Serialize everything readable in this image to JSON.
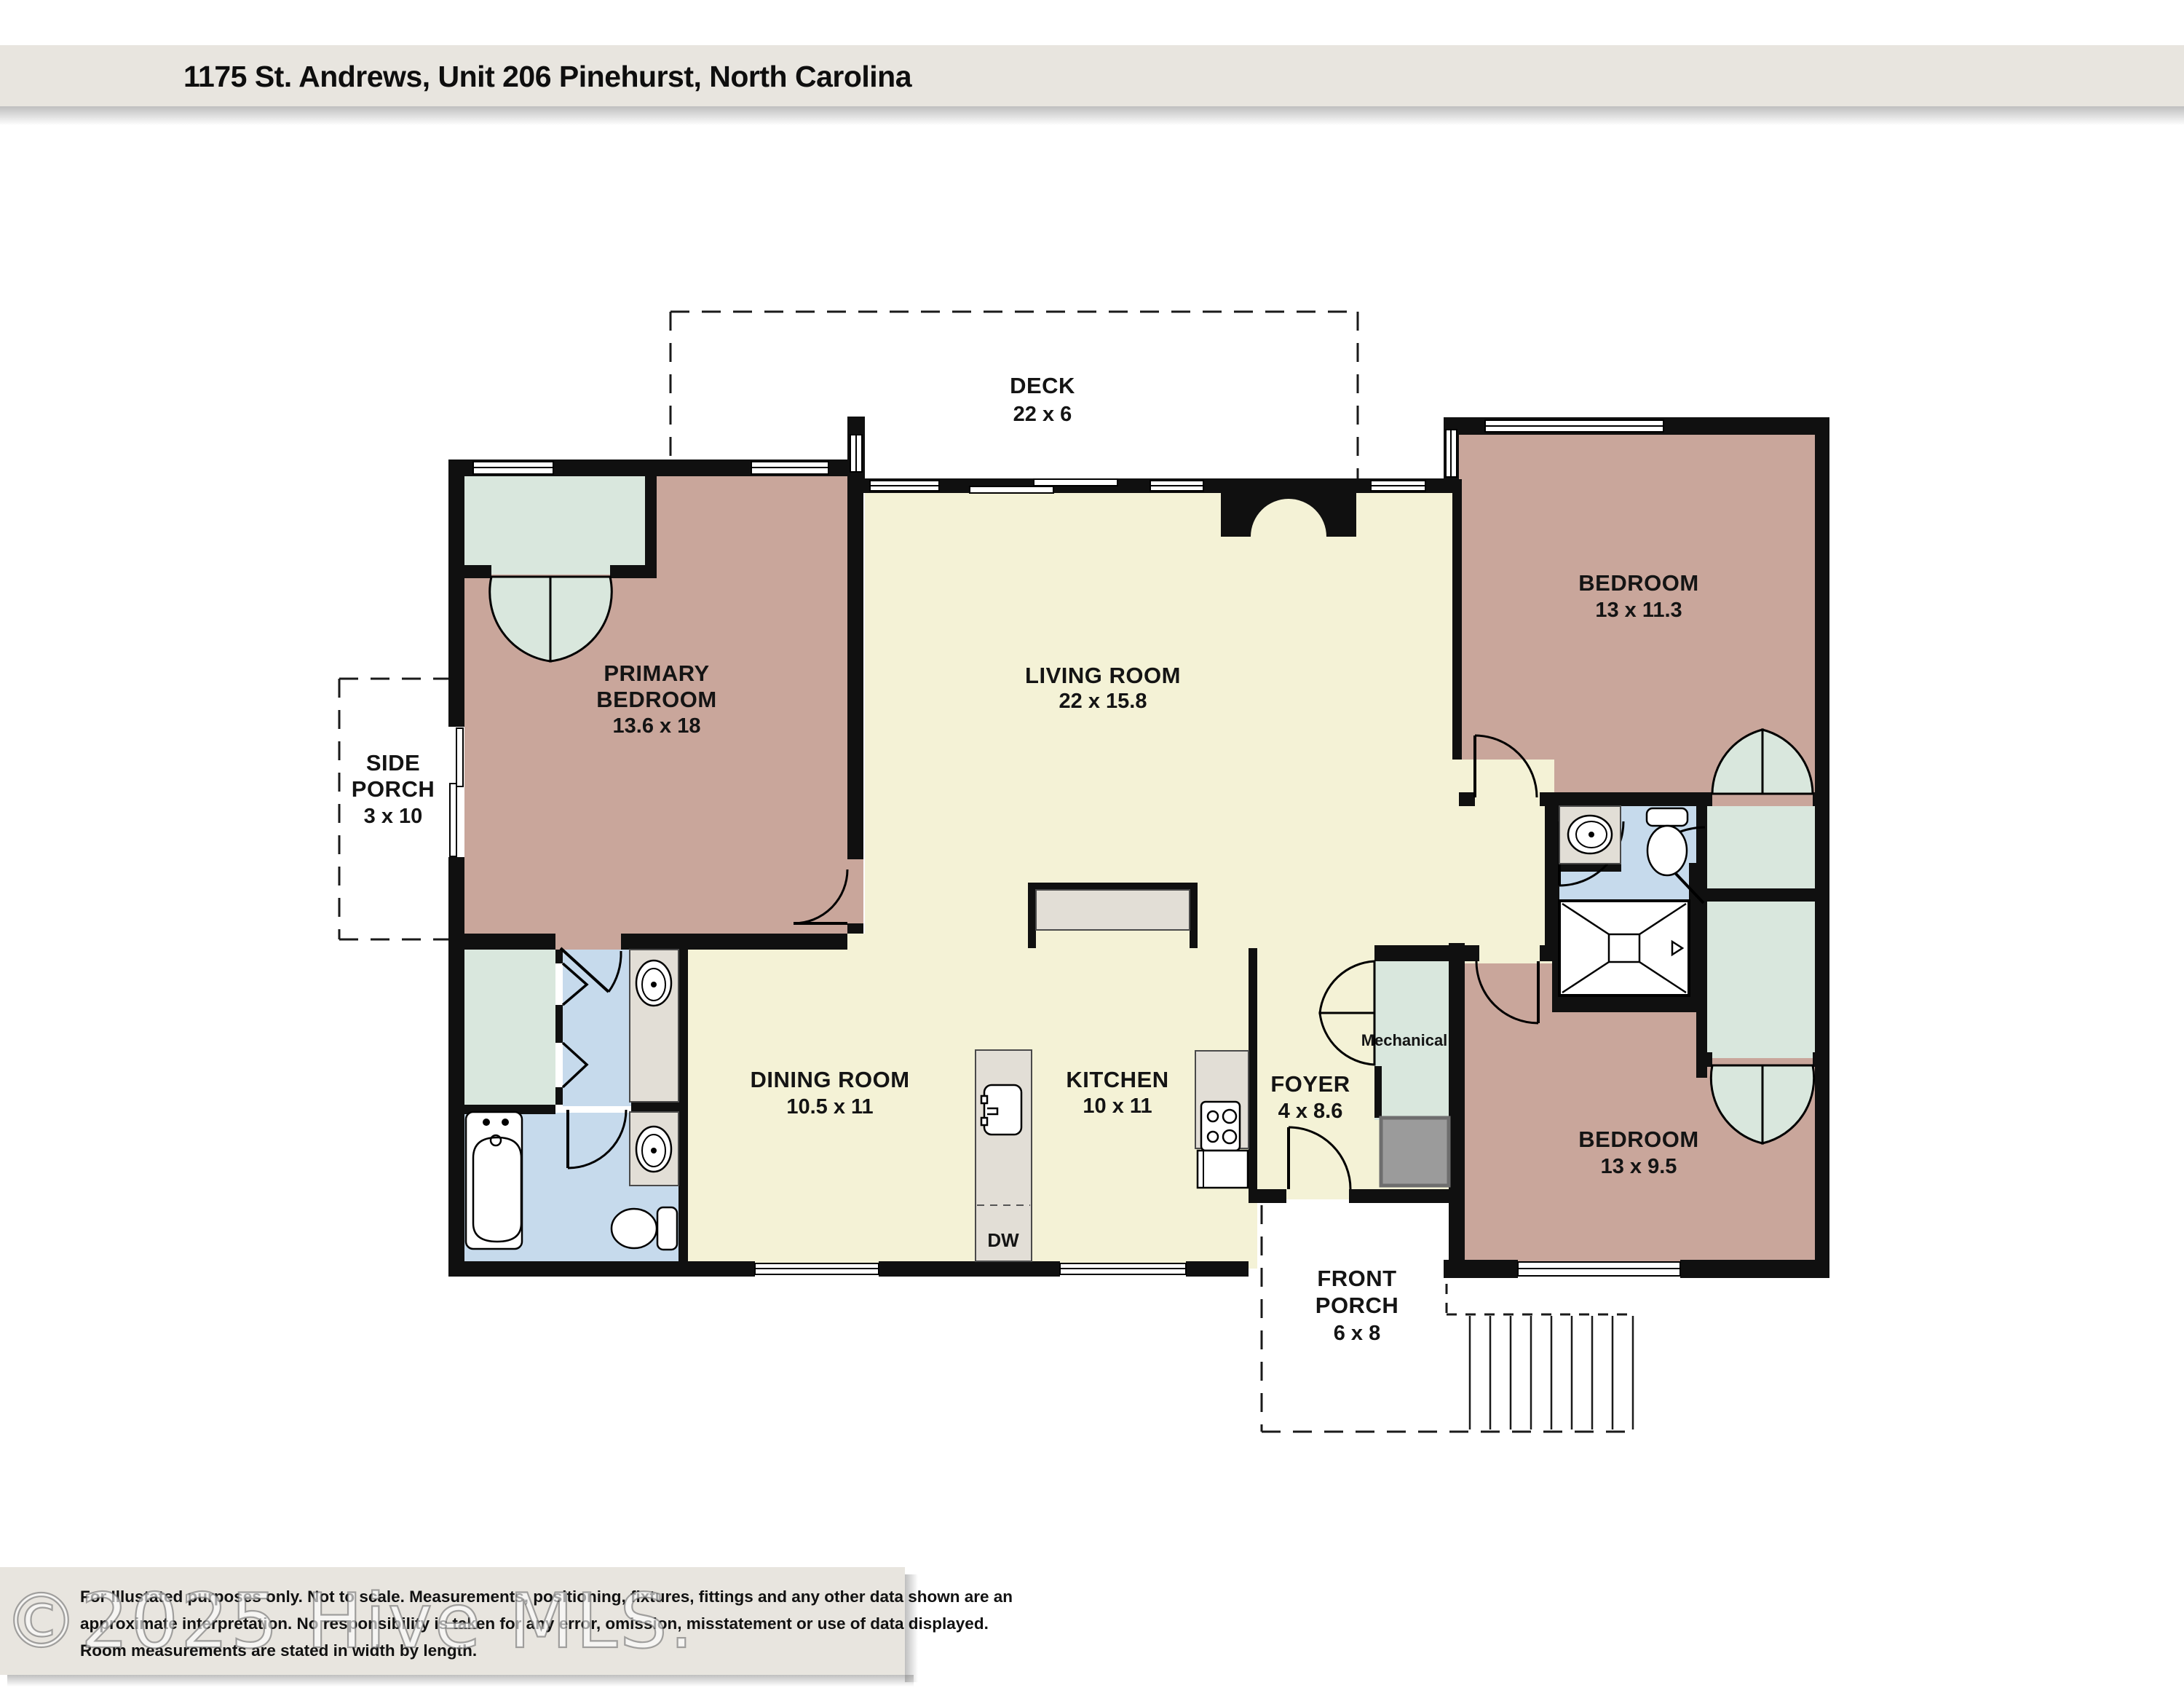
{
  "header": {
    "title": "1175 St. Andrews, Unit 206  Pinehurst, North Carolina"
  },
  "watermark": "©2025 Hive MLS.",
  "disclaimer": {
    "line1": "For Illustated purposes only. Not to scale. Measurements, positioning, fixtures, fittings and any other data shown are an",
    "line2": "approximate interpretation. No responsibility is taken for any error, omission, misstatement or use of data displayed.",
    "line3": "Room measurements are stated in width by length."
  },
  "rooms": {
    "deck": {
      "name": "DECK",
      "dims": "22 x 6"
    },
    "side_porch": {
      "l1": "SIDE",
      "l2": "PORCH",
      "dims": "3 x 10"
    },
    "primary_bedroom": {
      "l1": "PRIMARY",
      "l2": "BEDROOM",
      "dims": "13.6 x 18"
    },
    "living_room": {
      "name": "LIVING ROOM",
      "dims": "22 x 15.8"
    },
    "bedroom_top": {
      "name": "BEDROOM",
      "dims": "13 x 11.3"
    },
    "dining_room": {
      "name": "DINING ROOM",
      "dims": "10.5 x 11"
    },
    "kitchen": {
      "name": "KITCHEN",
      "dims": "10 x 11"
    },
    "foyer": {
      "name": "FOYER",
      "dims": "4 x 8.6"
    },
    "mechanical": {
      "name": "Mechanical"
    },
    "bedroom_bottom": {
      "name": "BEDROOM",
      "dims": "13 x 9.5"
    },
    "front_porch": {
      "l1": "FRONT",
      "l2": "PORCH",
      "dims": "6 x 8"
    },
    "dishwasher": {
      "label": "DW"
    }
  },
  "colors": {
    "bedroom_fill": "#c9a69b",
    "living_fill": "#f4f2d6",
    "closet_fill": "#d9e7dd",
    "bath_fill": "#c6daec",
    "counter_fill": "#e2ded6",
    "mat_fill": "#9b9b9b",
    "wall": "#101010",
    "band_bg": "#e8e5df"
  }
}
